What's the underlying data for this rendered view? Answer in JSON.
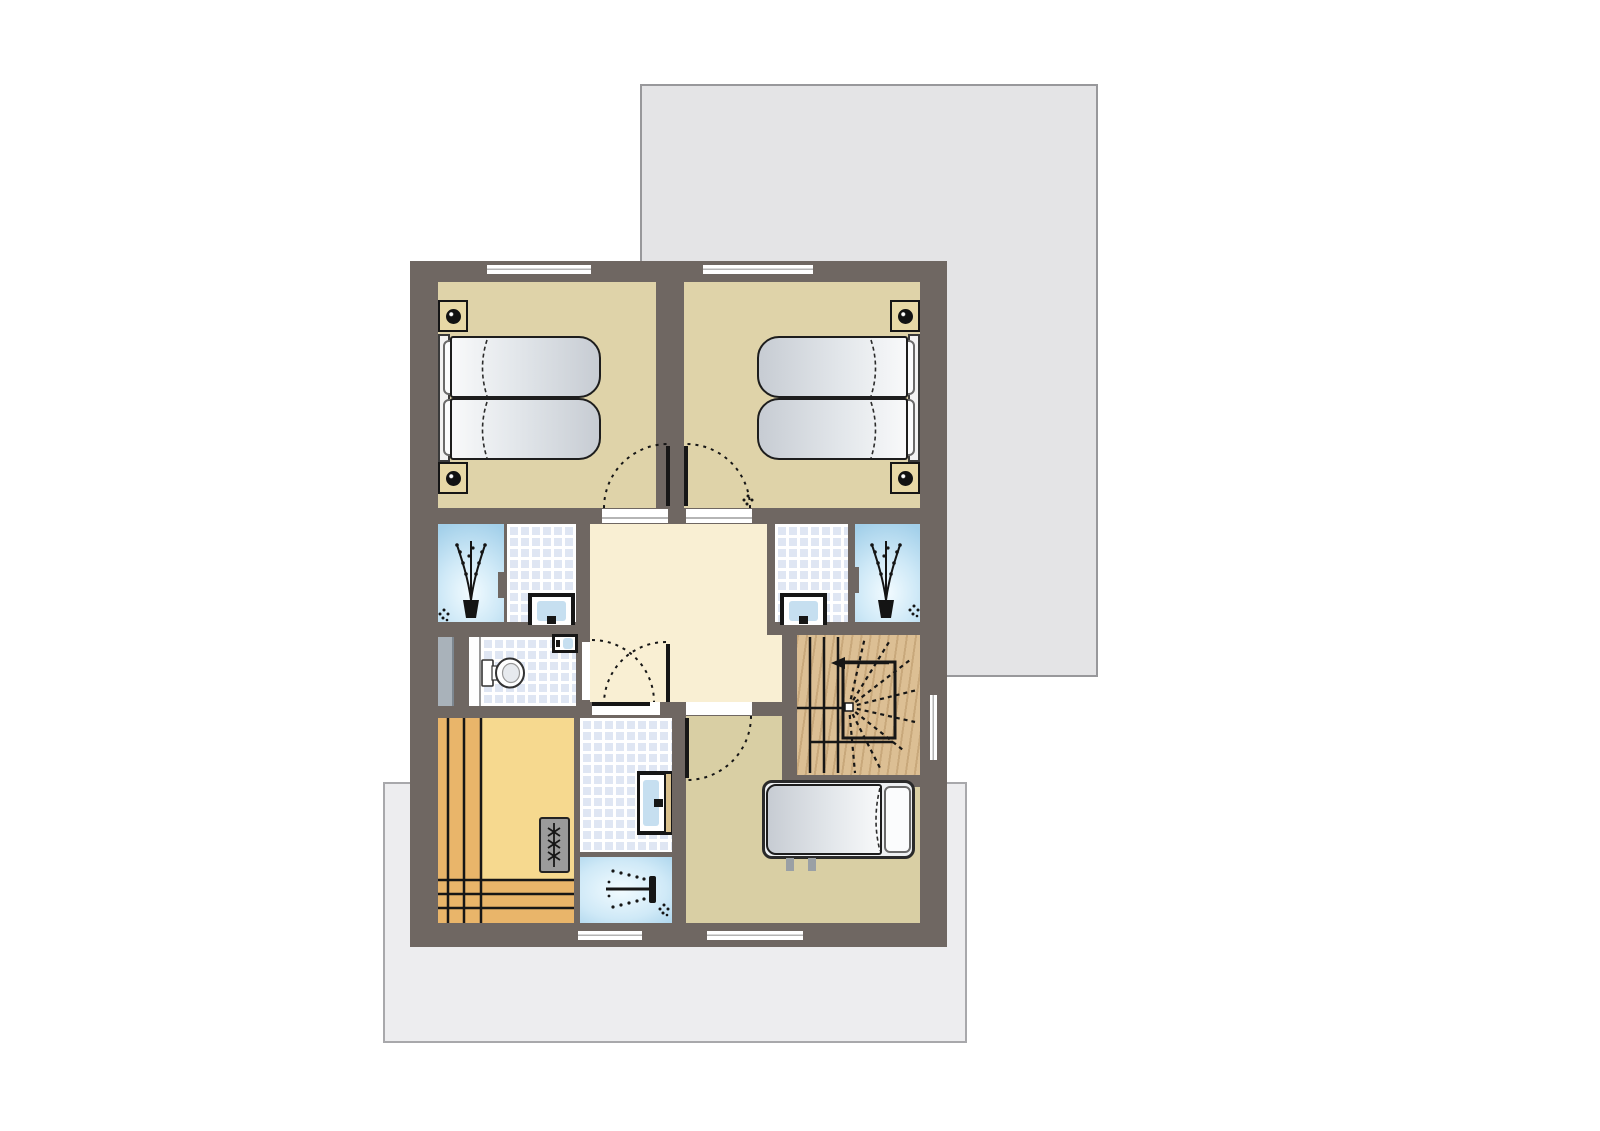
{
  "meta": {
    "kind": "architectural-floor-plan",
    "storey": "upper-floor",
    "visible_text": "none"
  },
  "palette": {
    "background": "#ffffff",
    "wall": "#6f6762",
    "bedroom_floor": "#dfd3a9",
    "bedroom3_floor": "#d9cfa4",
    "hall_floor": "#f9efd3",
    "sauna_floor": "#f6d98f",
    "bench_wood": "#e9b56a",
    "stair_wood": "#dcbf94",
    "tile_blue": "#dfe6f3",
    "glass_dark": "#a3d0ea",
    "glass_mid": "#cfe9f7",
    "glass_light": "#f2fbff",
    "roof_gray": "#e4e4e6",
    "roof_border": "#98989b",
    "terrace_gray": "#ededef",
    "terrace_border": "#a8a8ab",
    "shaft_gray": "#a9b2ba",
    "outline_dark": "#161616",
    "mattress_hi": "#f8f9fa",
    "mattress_lo": "#c7ccd3",
    "nightstand_tan": "#e7d8a6",
    "basin_blue": "#c6dff0",
    "heater_gray": "#9b9b9b",
    "counter_tan": "#d9c08c"
  },
  "rooms": [
    {
      "id": "bedroom-top-left"
    },
    {
      "id": "bedroom-top-right"
    },
    {
      "id": "glass-alcove-left"
    },
    {
      "id": "shower-room-left"
    },
    {
      "id": "landing-hall"
    },
    {
      "id": "shower-room-right"
    },
    {
      "id": "glass-alcove-right"
    },
    {
      "id": "wc"
    },
    {
      "id": "sauna"
    },
    {
      "id": "bathroom-shower"
    },
    {
      "id": "bedroom-bottom"
    },
    {
      "id": "winder-staircase"
    }
  ],
  "icons": [
    "bed-lamp-icon",
    "plant-icon",
    "flower-icon",
    "toilet-icon",
    "washbasin-icon",
    "corner-basin-icon",
    "sauna-heater-icon",
    "shower-head-icon",
    "stair-direction-arrow",
    "door-swing-arc",
    "window-slot"
  ]
}
